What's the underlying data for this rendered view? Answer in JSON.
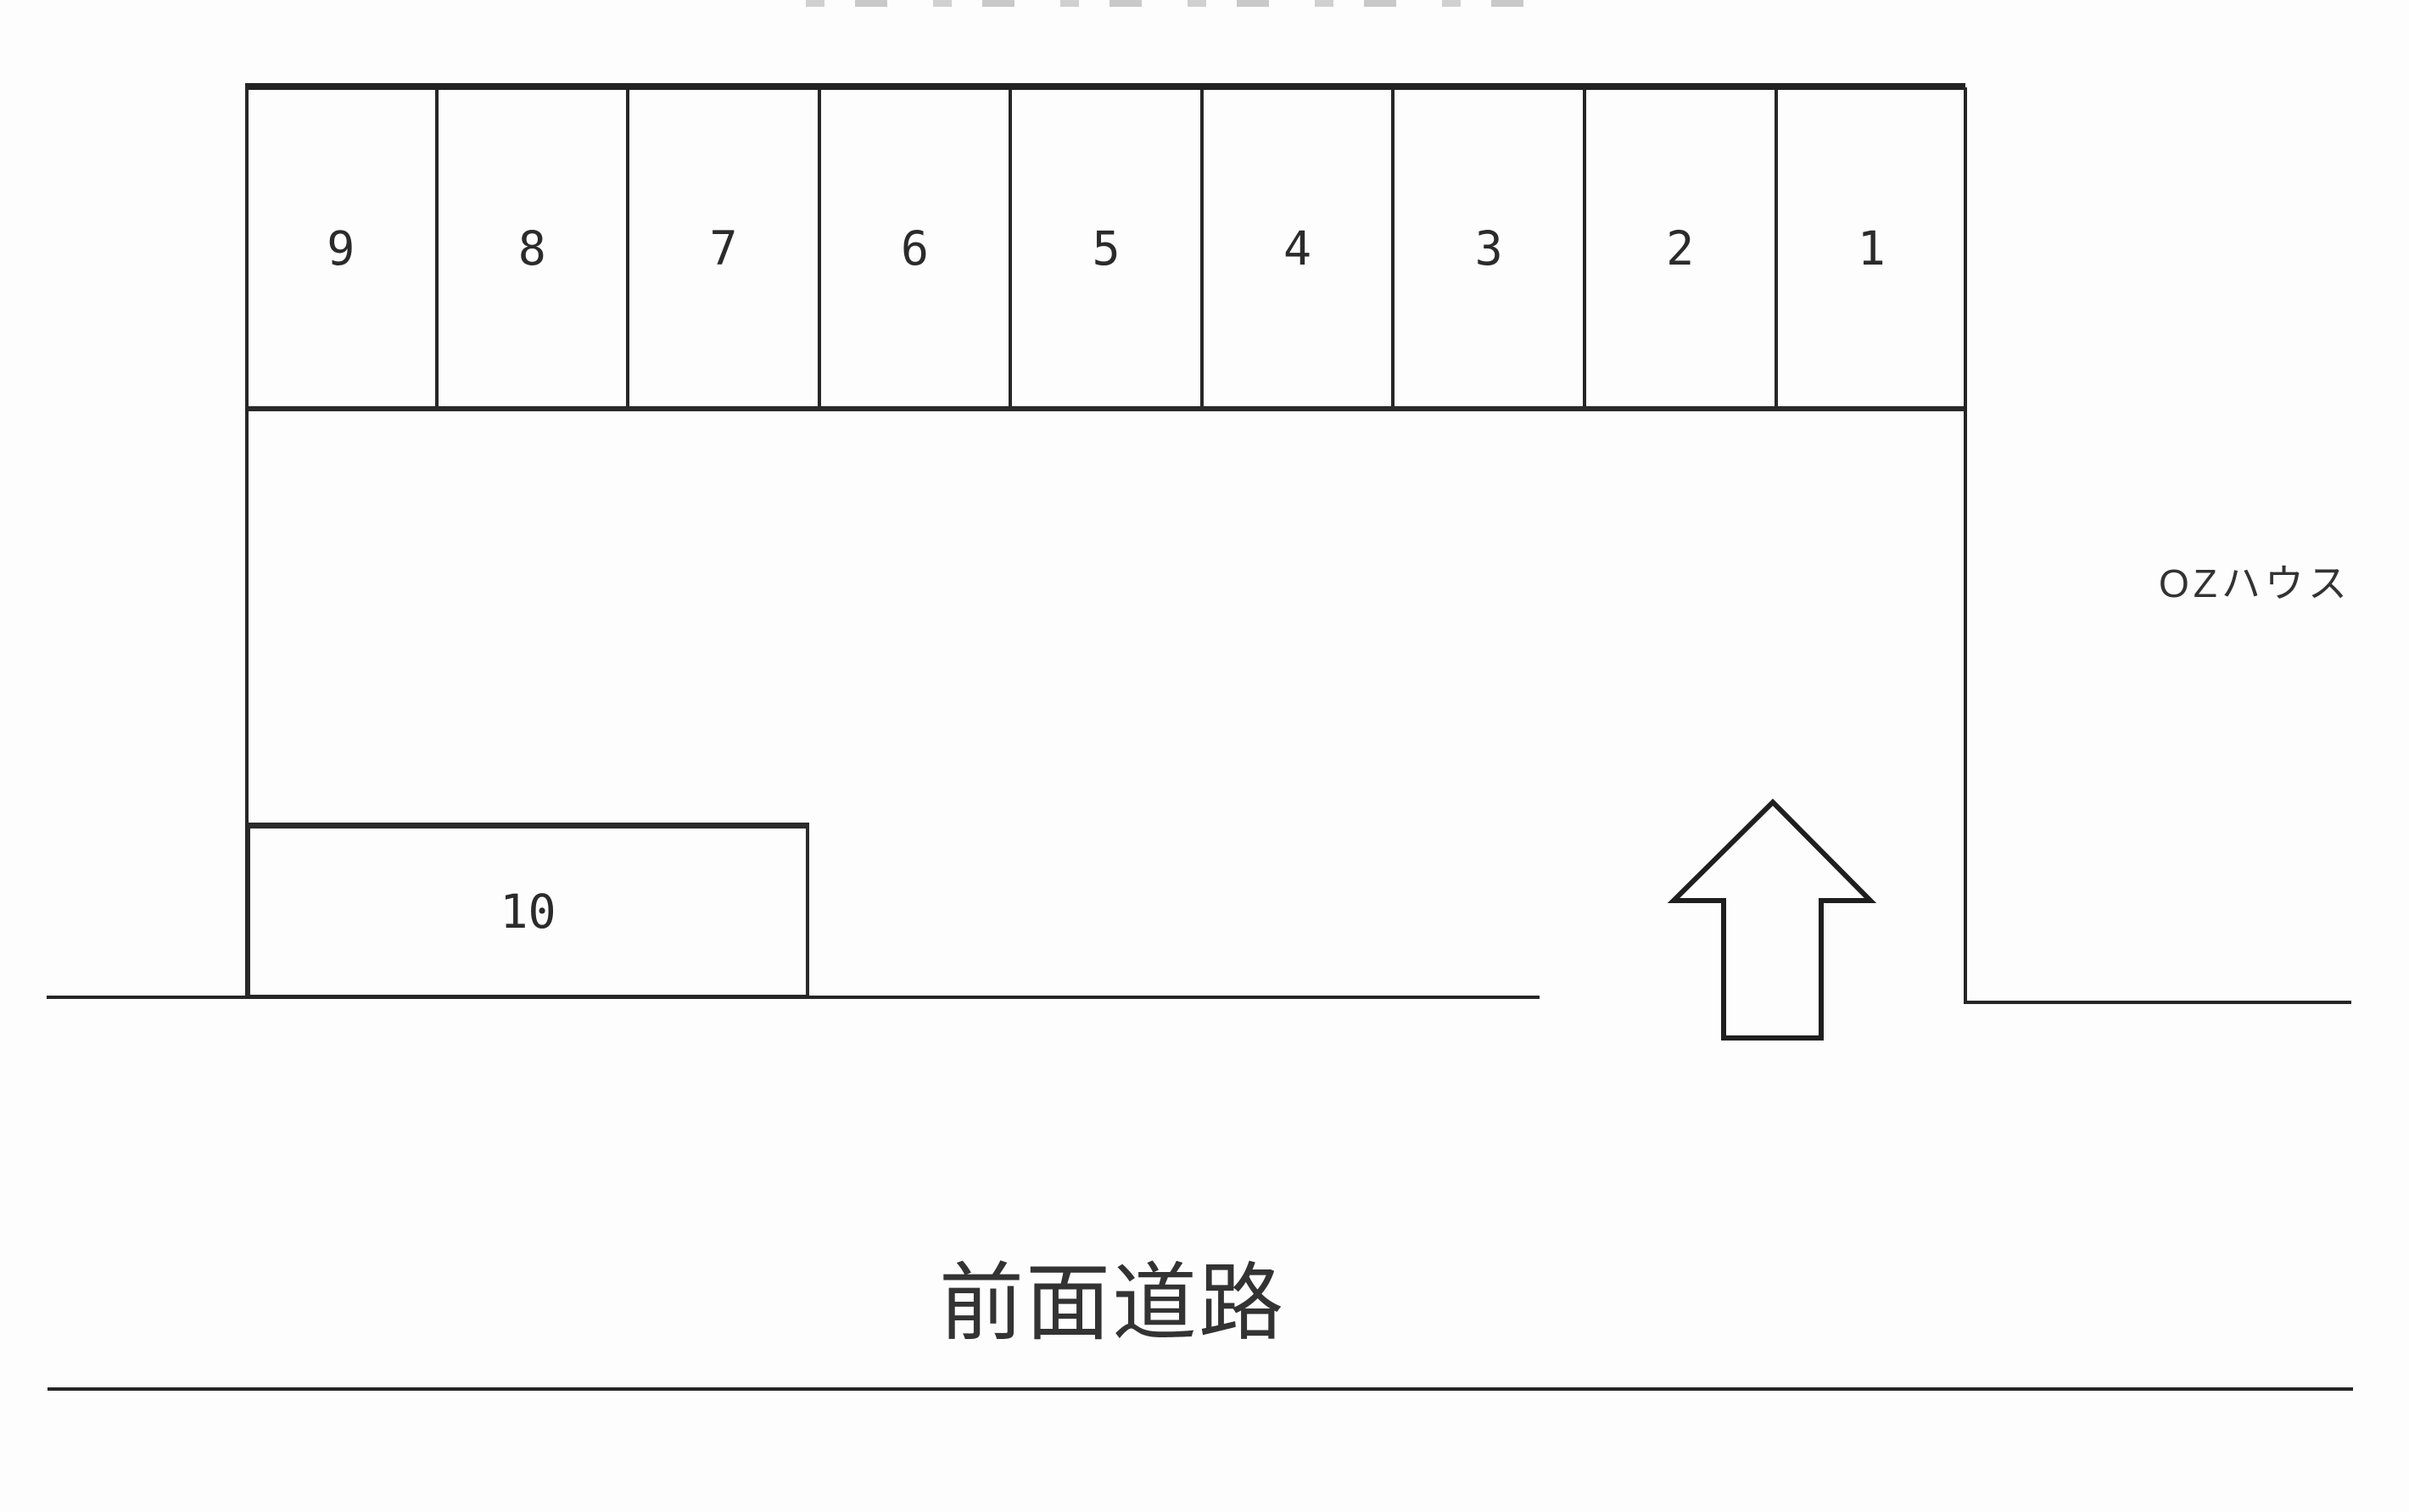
{
  "page": {
    "background_color": "#fdfdfd",
    "line_color": "#262626",
    "text_color": "#303030"
  },
  "parking_lot": {
    "row_spaces": [
      "9",
      "8",
      "7",
      "6",
      "5",
      "4",
      "3",
      "2",
      "1"
    ],
    "wide_space": "10",
    "building_label": "OZハウス",
    "road_label": "前面道路",
    "entrance_arrow": "up-arrow"
  }
}
